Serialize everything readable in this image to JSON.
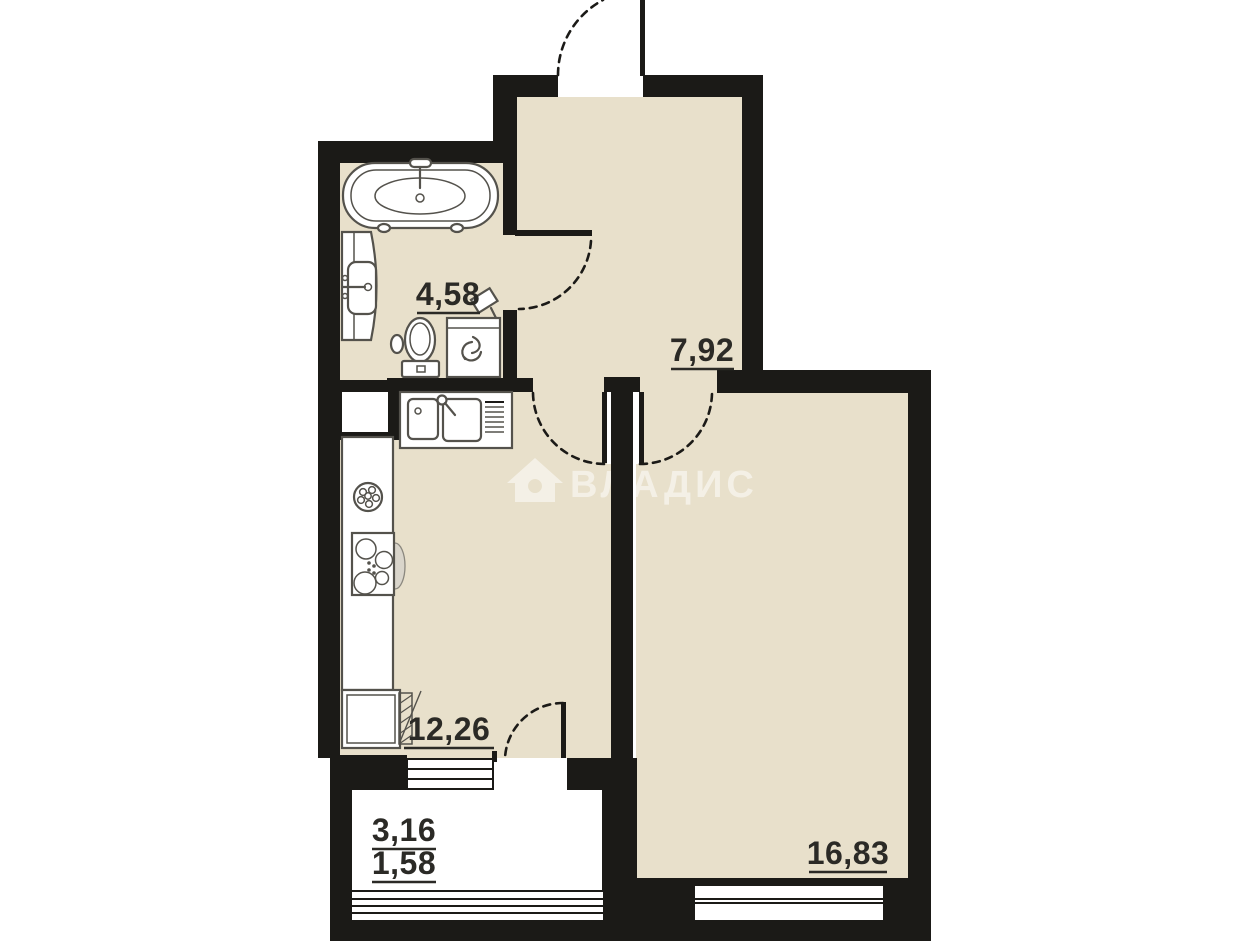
{
  "plan": {
    "type": "apartment-floor-plan",
    "watermark": {
      "text": "ВЛАДИС"
    },
    "rooms": {
      "bathroom": {
        "area": "4,58"
      },
      "hallway": {
        "area": "7,92"
      },
      "kitchen": {
        "area": "12,26"
      },
      "living_room": {
        "area": "16,83"
      },
      "balcony": {
        "area_total": "3,16",
        "area_reduced": "1,58"
      }
    },
    "colors": {
      "floor": "#e8e0cb",
      "wall": "#1b1a17",
      "balcony_floor": "#ffffff",
      "watermark": "rgba(255,255,255,0.52)"
    }
  }
}
